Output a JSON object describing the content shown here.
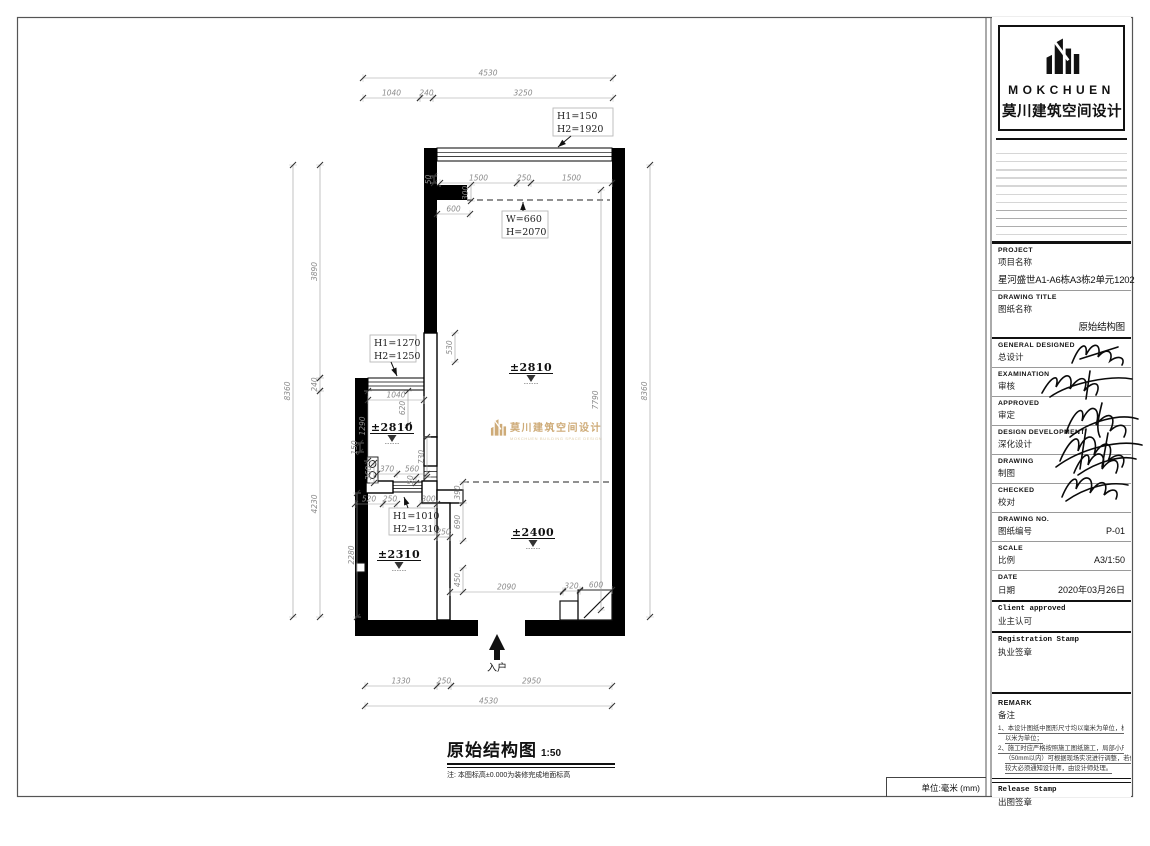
{
  "page": {
    "unit_label": "单位:毫米 (mm)"
  },
  "title_block": {
    "logo": {
      "brand": "MOKCHUEN",
      "brand_cn": "莫川建筑空间设计"
    },
    "project": {
      "label_en": "PROJECT",
      "label_cn": "项目名称",
      "value": "星河盛世A1-A6栋A3栋2单元1202"
    },
    "drawing_title": {
      "label_en": "DRAWING TITLE",
      "label_cn": "图纸名称",
      "value": "原始结构图"
    },
    "sign_rows": [
      {
        "label_en": "GENERAL DESIGNED",
        "label_cn": "总设计"
      },
      {
        "label_en": "EXAMINATION",
        "label_cn": "审核"
      },
      {
        "label_en": "APPROVED",
        "label_cn": "审定"
      },
      {
        "label_en": "DESIGN DEVELOPMENT",
        "label_cn": "深化设计"
      },
      {
        "label_en": "DRAWING",
        "label_cn": "制图"
      },
      {
        "label_en": "CHECKED",
        "label_cn": "校对"
      }
    ],
    "drawing_no": {
      "label_en": "DRAWING NO.",
      "label_cn": "图纸编号",
      "value": "P-01"
    },
    "scale": {
      "label_en": "SCALE",
      "label_cn": "比例",
      "value": "A3/1:50"
    },
    "date": {
      "label_en": "DATE",
      "label_cn": "日期",
      "value": "2020年03月26日"
    },
    "client": {
      "label_en": "Client approved",
      "label_cn": "业主认可"
    },
    "registration": {
      "label_en": "Registration Stamp",
      "label_cn": "执业签章"
    },
    "remark": {
      "label_en": "REMARK",
      "label_cn": "备注",
      "notes": [
        [
          "1、本设计图纸中图形尺寸均以毫米为单位，标高",
          "以米为单位；"
        ],
        [
          "2、施工时应严格按照施工图纸施工，局部小尺寸",
          "（50mm以内）可根据现场实况进行调整，若偏差",
          "较大必须通知设计师，由设计师处理。"
        ]
      ]
    },
    "release": {
      "label_en": "Release Stamp",
      "label_cn": "出图签章"
    }
  },
  "plan": {
    "entry_label": "入户",
    "watermark": {
      "cn": "莫川建筑空间设计",
      "en": "MOKCHUEN BUILDING SPACE DESIGN"
    },
    "dims_h": [
      {
        "v": "4530",
        "x1": 363,
        "x2": 613,
        "y": 78
      },
      {
        "v": "1040",
        "x1": 363,
        "x2": 420,
        "y": 98
      },
      {
        "v": "240",
        "x1": 420,
        "x2": 433,
        "y": 98
      },
      {
        "v": "3250",
        "x1": 433,
        "x2": 613,
        "y": 98
      },
      {
        "v": "1500",
        "x1": 440,
        "x2": 517,
        "y": 183
      },
      {
        "v": "250",
        "x1": 517,
        "x2": 531,
        "y": 183
      },
      {
        "v": "1500",
        "x1": 531,
        "x2": 612,
        "y": 183
      },
      {
        "v": "600",
        "x1": 437,
        "x2": 470,
        "y": 214
      },
      {
        "v": "1040",
        "x1": 368,
        "x2": 424,
        "y": 400
      },
      {
        "v": "370",
        "x1": 377,
        "x2": 397,
        "y": 474
      },
      {
        "v": "560",
        "x1": 397,
        "x2": 427,
        "y": 474
      },
      {
        "v": "520",
        "x1": 355,
        "x2": 383,
        "y": 504
      },
      {
        "v": "250",
        "x1": 383,
        "x2": 397,
        "y": 504
      },
      {
        "v": "300",
        "x1": 420,
        "x2": 437,
        "y": 504
      },
      {
        "v": "250",
        "x1": 437,
        "x2": 450,
        "y": 537
      },
      {
        "v": "2090",
        "x1": 450,
        "x2": 563,
        "y": 592
      },
      {
        "v": "320",
        "x1": 563,
        "x2": 580,
        "y": 591
      },
      {
        "v": "600",
        "x1": 580,
        "x2": 612,
        "y": 590
      },
      {
        "v": "1330",
        "x1": 365,
        "x2": 437,
        "y": 686
      },
      {
        "v": "250",
        "x1": 437,
        "x2": 451,
        "y": 686
      },
      {
        "v": "2950",
        "x1": 451,
        "x2": 612,
        "y": 686
      },
      {
        "v": "4530",
        "x1": 365,
        "x2": 612,
        "y": 706
      }
    ],
    "dims_v": [
      {
        "v": "8360",
        "x": 293,
        "y1": 165,
        "y2": 617
      },
      {
        "v": "3890",
        "x": 320,
        "y1": 165,
        "y2": 378
      },
      {
        "v": "240",
        "x": 320,
        "y1": 378,
        "y2": 391
      },
      {
        "v": "4230",
        "x": 320,
        "y1": 391,
        "y2": 617
      },
      {
        "v": "8360",
        "x": 650,
        "y1": 165,
        "y2": 617
      },
      {
        "v": "7790",
        "x": 601,
        "y1": 190,
        "y2": 610
      },
      {
        "v": "50",
        "x": 434,
        "y1": 176,
        "y2": 183
      },
      {
        "v": "300",
        "x": 471,
        "y1": 185,
        "y2": 201
      },
      {
        "v": "530",
        "x": 455,
        "y1": 333,
        "y2": 362
      },
      {
        "v": "620",
        "x": 408,
        "y1": 391,
        "y2": 425
      },
      {
        "v": "1290",
        "x": 368,
        "y1": 391,
        "y2": 461
      },
      {
        "v": "150",
        "x": 360,
        "y1": 443,
        "y2": 452
      },
      {
        "v": "730",
        "x": 427,
        "y1": 437,
        "y2": 477
      },
      {
        "v": "360",
        "x": 374,
        "y1": 463,
        "y2": 483
      },
      {
        "v": "50",
        "x": 416,
        "y1": 477,
        "y2": 483
      },
      {
        "v": "390",
        "x": 463,
        "y1": 482,
        "y2": 503
      },
      {
        "v": "690",
        "x": 463,
        "y1": 503,
        "y2": 541
      },
      {
        "v": "2280",
        "x": 357,
        "y1": 493,
        "y2": 617
      },
      {
        "v": "450",
        "x": 463,
        "y1": 568,
        "y2": 592
      }
    ],
    "elevations": [
      {
        "v": "±2810",
        "x": 531,
        "y": 371
      },
      {
        "v": "±2810",
        "x": 392,
        "y": 431
      },
      {
        "v": "±2400",
        "x": 533,
        "y": 536
      },
      {
        "v": "±2310",
        "x": 399,
        "y": 558
      }
    ],
    "label_boxes": [
      {
        "l1": "H1=150",
        "l2": "H2=1920",
        "x": 553,
        "y": 108,
        "w": 60,
        "h": 28,
        "sx": 571,
        "sy": 136,
        "ax": 558,
        "ay": 147
      },
      {
        "l1": "W=660",
        "l2": "H=2070",
        "x": 502,
        "y": 211,
        "w": 46,
        "h": 27,
        "sx": 523,
        "sy": 211,
        "ax": 523,
        "ay": 202
      },
      {
        "l1": "H1=1270",
        "l2": "H2=1250",
        "x": 370,
        "y": 335,
        "w": 46,
        "h": 27,
        "sx": 391,
        "sy": 362,
        "ax": 397,
        "ay": 376
      },
      {
        "l1": "H1=1010",
        "l2": "H2=1310",
        "x": 389,
        "y": 508,
        "w": 46,
        "h": 27,
        "sx": 408,
        "sy": 508,
        "ax": 404,
        "ay": 497
      }
    ]
  },
  "footer": {
    "title": "原始结构图",
    "scale": "1:50",
    "note": "注: 本图标高±0.000为装修完成地面标高"
  }
}
